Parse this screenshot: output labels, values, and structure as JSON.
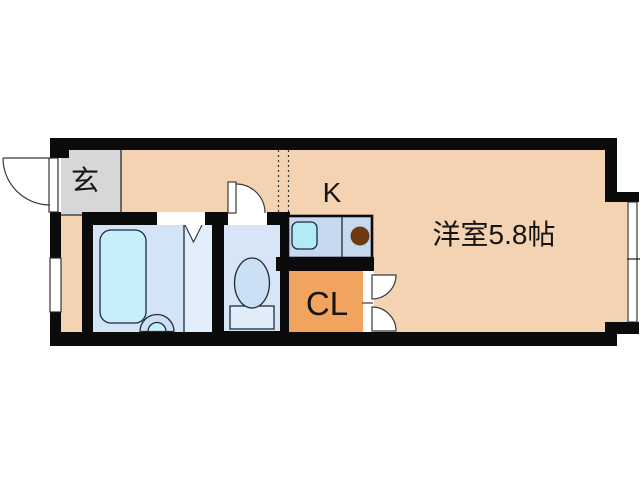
{
  "floorplan": {
    "labels": {
      "entrance": "玄",
      "kitchen": "K",
      "main_room": "洋室5.8帖",
      "closet": "CL"
    },
    "colors": {
      "background": "#ffffff",
      "wall": "#0b0b0b",
      "floor": "#f4d3b3",
      "entrance_floor": "#d7d7d9",
      "closet_floor": "#f0a45f",
      "bath_floor": "#d3e4f7",
      "bath_floor_light": "#e2eefb",
      "bathtub": "#c6effa",
      "toilet_floor": "#d7e5f6",
      "fixture_fill": "#cbdff5",
      "fixture_light": "#e1ecf9",
      "counter": "#c7d9ef",
      "sink": "#b2ebf5",
      "burner": "#6e3a10"
    }
  }
}
